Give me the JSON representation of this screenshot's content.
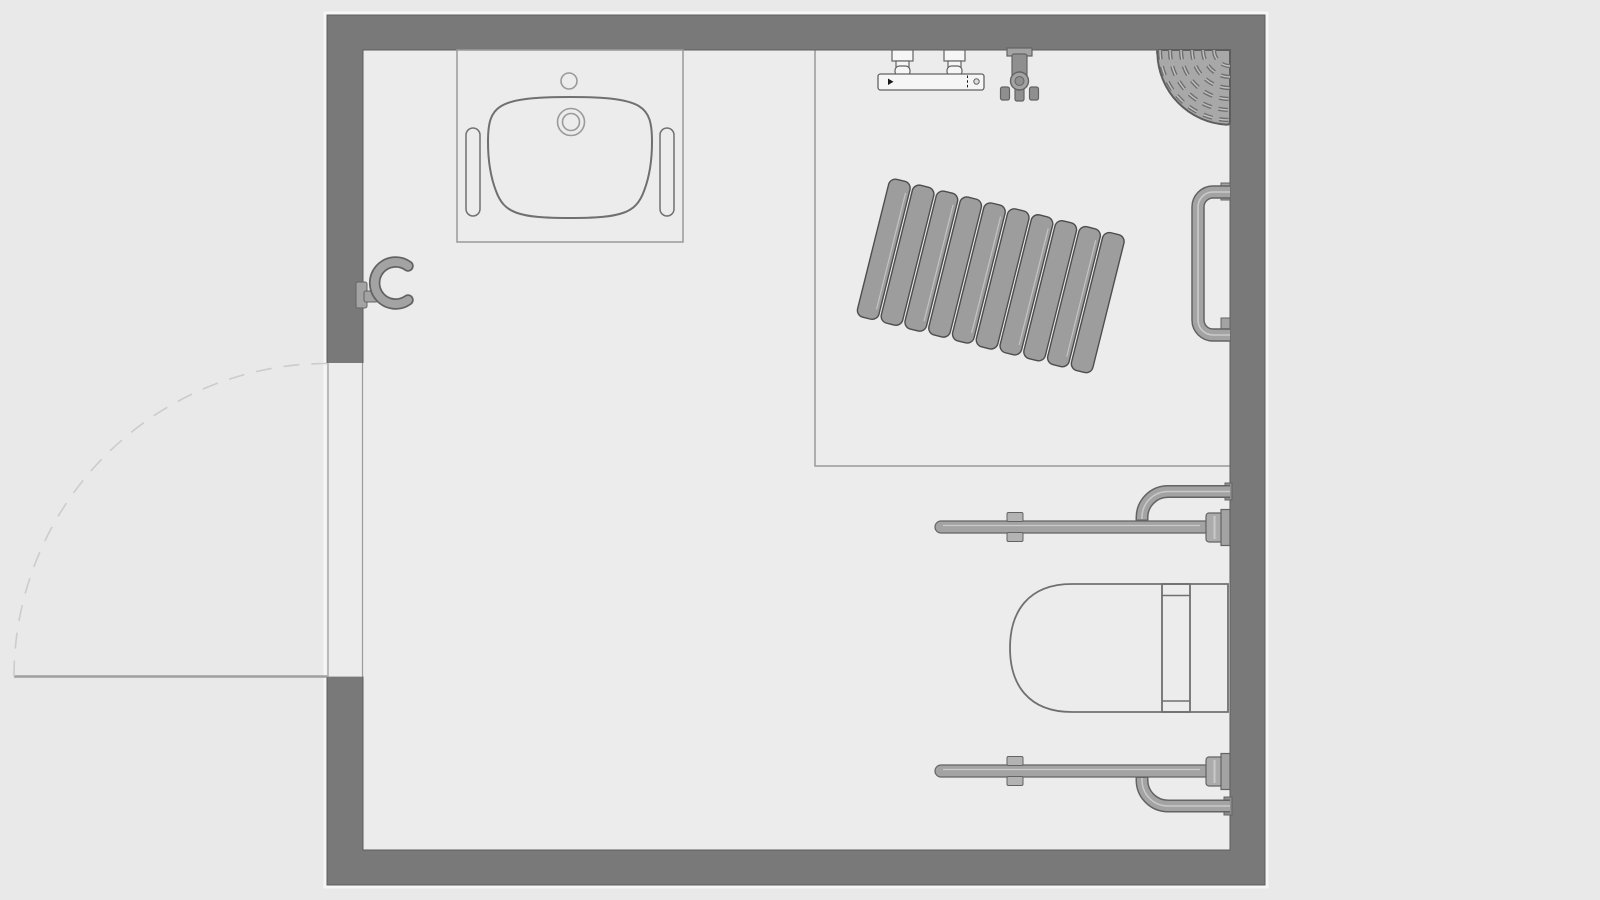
{
  "floor_plan": {
    "type": "bathroom-top-view",
    "room": {
      "outer_wall_box": [
        327,
        15,
        1265,
        885
      ],
      "inner_box": [
        363,
        50,
        1230,
        850
      ],
      "wall_thickness": 36
    },
    "door": {
      "wall": "left",
      "opening_span_y": [
        363,
        677
      ],
      "swing": "quarter-arc-outward",
      "hinge": "bottom"
    },
    "zones": [
      {
        "id": "shower-area",
        "boundary": [
          [
            815,
            50
          ],
          [
            815,
            466
          ],
          [
            1230,
            466
          ]
        ]
      }
    ],
    "fixtures": [
      {
        "id": "washbasin",
        "name": "washbasin-with-counter-and-grab-rails",
        "position": "top-left"
      },
      {
        "id": "coat-hook",
        "name": "c-shaped-wall-hook",
        "position": "left-wall"
      },
      {
        "id": "shower-mixer",
        "name": "thermostatic-shower-mixer",
        "position": "top-wall-shower-area"
      },
      {
        "id": "hand-shower-holder",
        "name": "hand-shower-wall-holder",
        "position": "top-wall-shower-area"
      },
      {
        "id": "corner-shower-head",
        "name": "corner-overhead-shower",
        "position": "top-right-corner"
      },
      {
        "id": "radiator",
        "name": "panel-radiator",
        "rotation_deg": 14,
        "slats": 10,
        "position": "shower-area-center"
      },
      {
        "id": "grab-rail-right",
        "name": "vertical-grab-rail",
        "position": "right-wall-shower-area"
      },
      {
        "id": "fold-up-rail-upper",
        "name": "fold-up-grab-rail",
        "position": "above-toilet"
      },
      {
        "id": "toilet",
        "name": "wall-hung-toilet",
        "position": "bottom-right"
      },
      {
        "id": "fold-up-rail-lower",
        "name": "fold-up-grab-rail",
        "position": "below-toilet"
      }
    ]
  },
  "colors": {
    "bg": "#e9e9e9",
    "room": "#ececec",
    "wall": "#797979",
    "wall-edge": "#5d5d5d",
    "wall-glow": "#f6f6f6",
    "outline": "#707070",
    "line": "#9a9a9a",
    "metal": "#a3a3a3",
    "metal-dark": "#636363",
    "metal-light": "#cacaca",
    "metal-mid": "#8f8f8f",
    "white-fixture": "#f6f6f6",
    "panel": "#9d9d9d",
    "panel-edge": "#4d4d4d",
    "swing": "#cccccc",
    "leaf": "#9f9f9f",
    "disc": "#a8a8a8",
    "disc-groove": "#6f6f6f",
    "disc-groove-light": "#c2c2c2",
    "mark": "#1a1a1a"
  }
}
